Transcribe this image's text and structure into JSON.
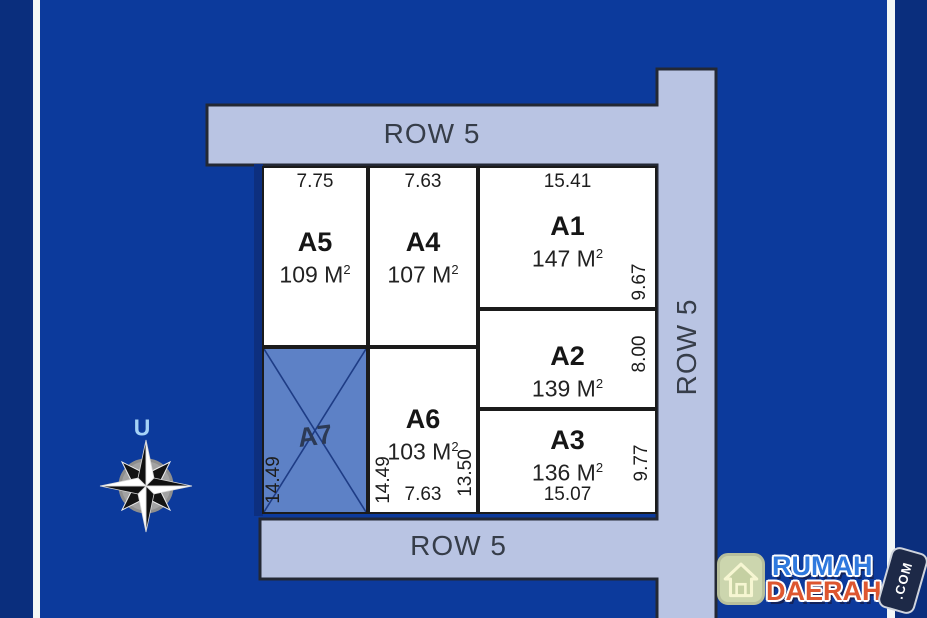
{
  "site_plan": {
    "roads": {
      "top_label": "ROW 5",
      "bottom_label": "ROW 5",
      "right_label": "ROW 5"
    },
    "compass": {
      "north_label": "U"
    },
    "plots": [
      {
        "id": "A1",
        "area": "147 M",
        "area_sup": "2",
        "dim_top": "15.41",
        "dim_right": "9.67"
      },
      {
        "id": "A2",
        "area": "139 M",
        "area_sup": "2",
        "dim_right": "8.00"
      },
      {
        "id": "A3",
        "area": "136 M",
        "area_sup": "2",
        "dim_bottom": "15.07",
        "dim_right": "9.77"
      },
      {
        "id": "A4",
        "area": "107 M",
        "area_sup": "2",
        "dim_top": "7.63",
        "dim_left": "14.49"
      },
      {
        "id": "A5",
        "area": "109 M",
        "area_sup": "2",
        "dim_top": "7.75",
        "dim_left": "14.49"
      },
      {
        "id": "A6",
        "area": "103 M",
        "area_sup": "2",
        "dim_bottom": "7.63",
        "dim_right": "13.50"
      },
      {
        "id": "A7",
        "crossed_out": true
      }
    ],
    "colors": {
      "background": "#0c3a9c",
      "outer_band": "#0a2e7d",
      "road_fill": "#b9c4e3",
      "plot_fill": "#ffffff",
      "crossed_plot_fill": "#5d81c6",
      "border_dark": "#232834"
    }
  },
  "logo": {
    "word1": "RUMAH",
    "word2": "DAERAH",
    "badge": ".COM"
  }
}
